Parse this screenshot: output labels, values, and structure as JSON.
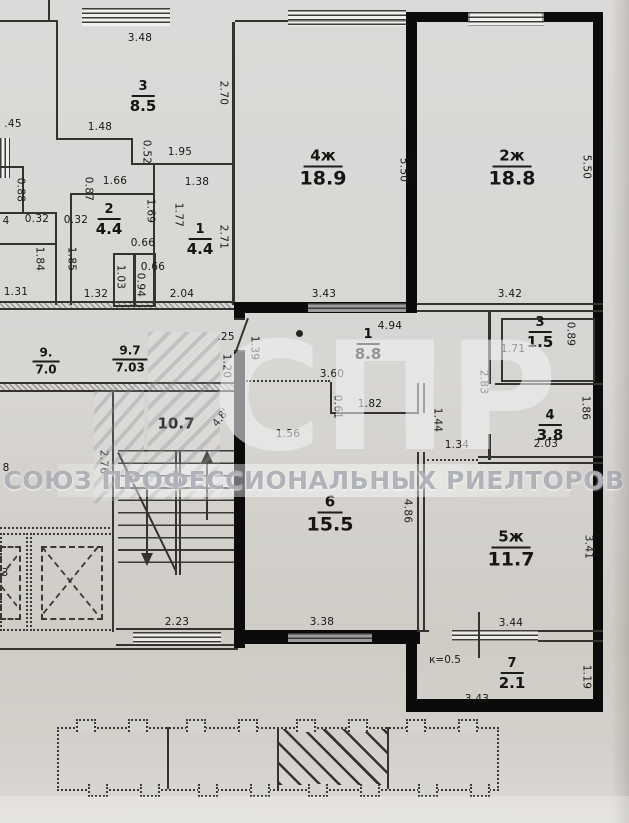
{
  "watermark": {
    "acronym": "СПР",
    "organization": "СОЮЗ ПРОФЕССИОНАЛЬНЫХ РИЕЛТОРОВ"
  },
  "rooms": [
    {
      "number": "3",
      "area": "8.5",
      "x": 143,
      "y": 97,
      "size": "md"
    },
    {
      "number": "2",
      "area": "4.4",
      "x": 109,
      "y": 220,
      "size": "md"
    },
    {
      "number": "1",
      "area": "4.4",
      "x": 200,
      "y": 240,
      "size": "md"
    },
    {
      "number": "4ж",
      "area": "18.9",
      "x": 323,
      "y": 168,
      "size": "lg"
    },
    {
      "number": "2ж",
      "area": "18.8",
      "x": 512,
      "y": 168,
      "size": "lg"
    },
    {
      "number": "1",
      "area": "8.8",
      "x": 368,
      "y": 345,
      "size": "md"
    },
    {
      "number": "3",
      "area": "1.5",
      "x": 540,
      "y": 333,
      "size": "md"
    },
    {
      "number": "4",
      "area": "3.8",
      "x": 550,
      "y": 426,
      "size": "md"
    },
    {
      "number": "6",
      "area": "15.5",
      "x": 330,
      "y": 514,
      "size": "lg"
    },
    {
      "number": "5ж",
      "area": "11.7",
      "x": 511,
      "y": 549,
      "size": "lg"
    },
    {
      "number": "7",
      "area": "2.1",
      "x": 512,
      "y": 674,
      "size": "md"
    },
    {
      "number": "9.",
      "area": "7.0",
      "x": 46,
      "y": 361,
      "size": "sm"
    },
    {
      "number": "9.7",
      "area": "7.03",
      "x": 130,
      "y": 359,
      "size": "sm"
    },
    {
      "number": "10.7",
      "area": "",
      "x": 176,
      "y": 424,
      "size": "plain"
    }
  ],
  "dimensions": [
    {
      "t": "3.48",
      "x": 140,
      "y": 38
    },
    {
      "t": "1.48",
      "x": 100,
      "y": 127
    },
    {
      "t": ".45",
      "x": 13,
      "y": 124
    },
    {
      "t": "2.70",
      "x": 223,
      "y": 93,
      "r": 90
    },
    {
      "t": "0.52",
      "x": 146,
      "y": 152,
      "r": 90
    },
    {
      "t": "1.95",
      "x": 180,
      "y": 152
    },
    {
      "t": "1.38",
      "x": 197,
      "y": 182
    },
    {
      "t": "0.88",
      "x": 20,
      "y": 190,
      "r": 90
    },
    {
      "t": "0.87",
      "x": 88,
      "y": 189,
      "r": 90
    },
    {
      "t": "1.66",
      "x": 115,
      "y": 181
    },
    {
      "t": "0.32",
      "x": 37,
      "y": 219
    },
    {
      "t": "0.32",
      "x": 76,
      "y": 220
    },
    {
      "t": "1.69",
      "x": 150,
      "y": 211,
      "r": 90
    },
    {
      "t": "1.77",
      "x": 178,
      "y": 215,
      "r": 90
    },
    {
      "t": "2.71",
      "x": 223,
      "y": 237,
      "r": 90
    },
    {
      "t": "0.66",
      "x": 143,
      "y": 243
    },
    {
      "t": "0.66",
      "x": 153,
      "y": 267
    },
    {
      "t": "1.85",
      "x": 71,
      "y": 259,
      "r": 90
    },
    {
      "t": "1.84",
      "x": 39,
      "y": 259,
      "r": 90
    },
    {
      "t": "1.03",
      "x": 120,
      "y": 277,
      "r": 90
    },
    {
      "t": "0.94",
      "x": 140,
      "y": 285,
      "r": 90
    },
    {
      "t": "1.31",
      "x": 16,
      "y": 292
    },
    {
      "t": "1.32",
      "x": 96,
      "y": 294
    },
    {
      "t": "2.04",
      "x": 182,
      "y": 294
    },
    {
      "t": "5.50",
      "x": 403,
      "y": 170,
      "r": 90
    },
    {
      "t": "3.43",
      "x": 324,
      "y": 294
    },
    {
      "t": "5.50",
      "x": 586,
      "y": 167,
      "r": 90
    },
    {
      "t": "3.42",
      "x": 510,
      "y": 294
    },
    {
      "t": "4.94",
      "x": 390,
      "y": 326
    },
    {
      "t": ".25",
      "x": 226,
      "y": 337
    },
    {
      "t": "1.20",
      "x": 226,
      "y": 366,
      "r": 90
    },
    {
      "t": "1.39",
      "x": 254,
      "y": 348,
      "r": 90
    },
    {
      "t": "3.60",
      "x": 332,
      "y": 374
    },
    {
      "t": "0.61",
      "x": 337,
      "y": 407,
      "r": 90
    },
    {
      "t": "1.82",
      "x": 370,
      "y": 404
    },
    {
      "t": "1.56",
      "x": 288,
      "y": 434
    },
    {
      "t": "1.44",
      "x": 437,
      "y": 420,
      "r": 90
    },
    {
      "t": "1.34",
      "x": 457,
      "y": 445
    },
    {
      "t": "2.83",
      "x": 483,
      "y": 382,
      "r": 90
    },
    {
      "t": "1.71",
      "x": 513,
      "y": 349
    },
    {
      "t": "0.89",
      "x": 570,
      "y": 334,
      "r": 90
    },
    {
      "t": "1.86",
      "x": 585,
      "y": 408,
      "r": 90
    },
    {
      "t": "2.03",
      "x": 546,
      "y": 444
    },
    {
      "t": "4.86",
      "x": 407,
      "y": 511,
      "r": 90
    },
    {
      "t": "3.38",
      "x": 322,
      "y": 622
    },
    {
      "t": "3.41",
      "x": 588,
      "y": 547,
      "r": 90
    },
    {
      "t": "3.44",
      "x": 511,
      "y": 623
    },
    {
      "t": "3.43",
      "x": 477,
      "y": 699
    },
    {
      "t": "1.19",
      "x": 586,
      "y": 677,
      "r": 90
    },
    {
      "t": "2.76",
      "x": 103,
      "y": 462,
      "r": 90
    },
    {
      "t": "2.23",
      "x": 177,
      "y": 622
    }
  ],
  "annotations": [
    {
      "t": "к=0.5",
      "x": 445,
      "y": 660
    },
    {
      "t": "4.8'",
      "x": 221,
      "y": 418,
      "r": -52
    },
    {
      "t": "4",
      "x": 6,
      "y": 221
    },
    {
      "t": "8",
      "x": 6,
      "y": 468
    },
    {
      "t": "3",
      "x": 5,
      "y": 573
    }
  ],
  "site_plan": {
    "sections": 4,
    "highlighted_section": 3
  }
}
